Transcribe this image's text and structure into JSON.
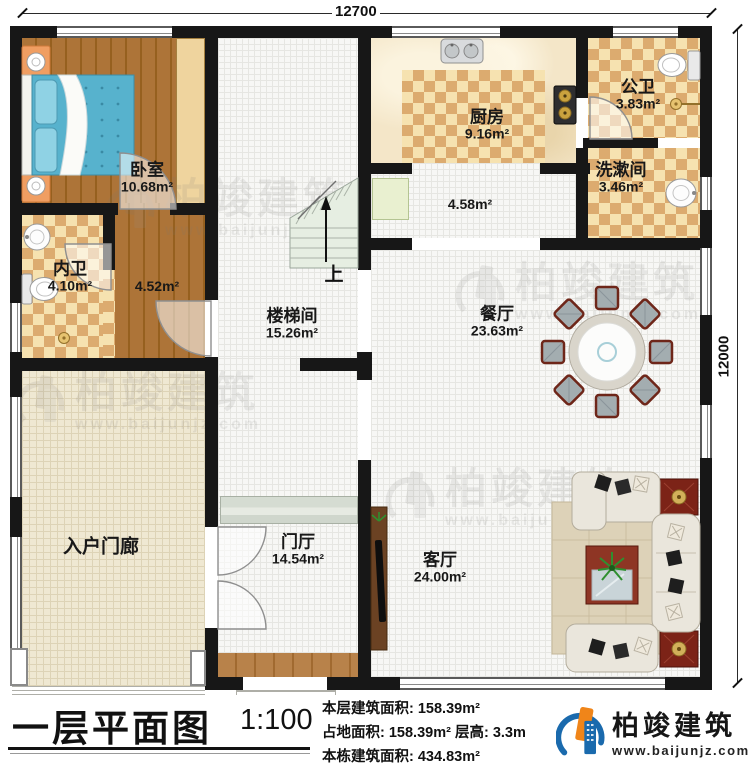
{
  "dimensions": {
    "width_top": "12700",
    "height_right": "12000"
  },
  "rooms": [
    {
      "name": "卧室",
      "area": "10.68m²"
    },
    {
      "name": "内卫",
      "area": "4.10m²"
    },
    {
      "name": "",
      "area": "4.52m²"
    },
    {
      "name": "楼梯间",
      "area": "15.26m²"
    },
    {
      "name": "厨房",
      "area": "9.16m²"
    },
    {
      "name": "公卫",
      "area": "3.83m²"
    },
    {
      "name": "洗漱间",
      "area": "3.46m²"
    },
    {
      "name": "",
      "area": "4.58m²"
    },
    {
      "name": "餐厅",
      "area": "23.63m²"
    },
    {
      "name": "入户门廊",
      "area": ""
    },
    {
      "name": "门厅",
      "area": "14.54m²"
    },
    {
      "name": "客厅",
      "area": "24.00m²"
    }
  ],
  "stair": {
    "up_label": "上"
  },
  "title_block": {
    "title": "一层平面图",
    "scale": "1:100",
    "stats": [
      "本层建筑面积: 158.39m²",
      "占地面积: 158.39m²  层高: 3.3m",
      "本栋建筑面积: 434.83m²"
    ]
  },
  "logo": {
    "brand": "柏竣建筑",
    "url": "www.baijunjz.com"
  },
  "watermark": {
    "brand": "柏竣建筑",
    "url": "www.baijunjz.com"
  },
  "colors": {
    "wall": "#171717",
    "wood_floor": "#a46c31",
    "checker_light": "#f6e2b0",
    "checker_dark": "#dcab6f",
    "brand_blue": "#1a6aad",
    "brand_orange": "#f08519",
    "chair_frame": "#6e2619",
    "sofa_cream": "#e9e5da",
    "table_red": "#8e3524",
    "bed_blue": "#57b2cd"
  }
}
